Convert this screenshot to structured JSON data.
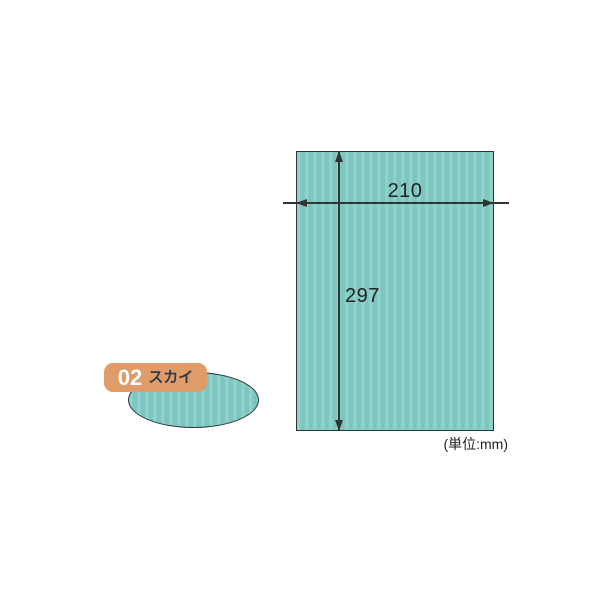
{
  "colors": {
    "background": "#ffffff",
    "paper_base": "#7dc6c0",
    "paper_stripe": "#90d2cb",
    "line": "#333333",
    "label_bg": "#df9c69",
    "label_number": "#ffffff",
    "label_name": "#333b42",
    "ellipse_outline": "#24323c"
  },
  "dimensions": {
    "width_label": "210",
    "height_label": "297",
    "unit_label": "(単位:mm)"
  },
  "swatch": {
    "number": "02",
    "name": "スカイ"
  }
}
